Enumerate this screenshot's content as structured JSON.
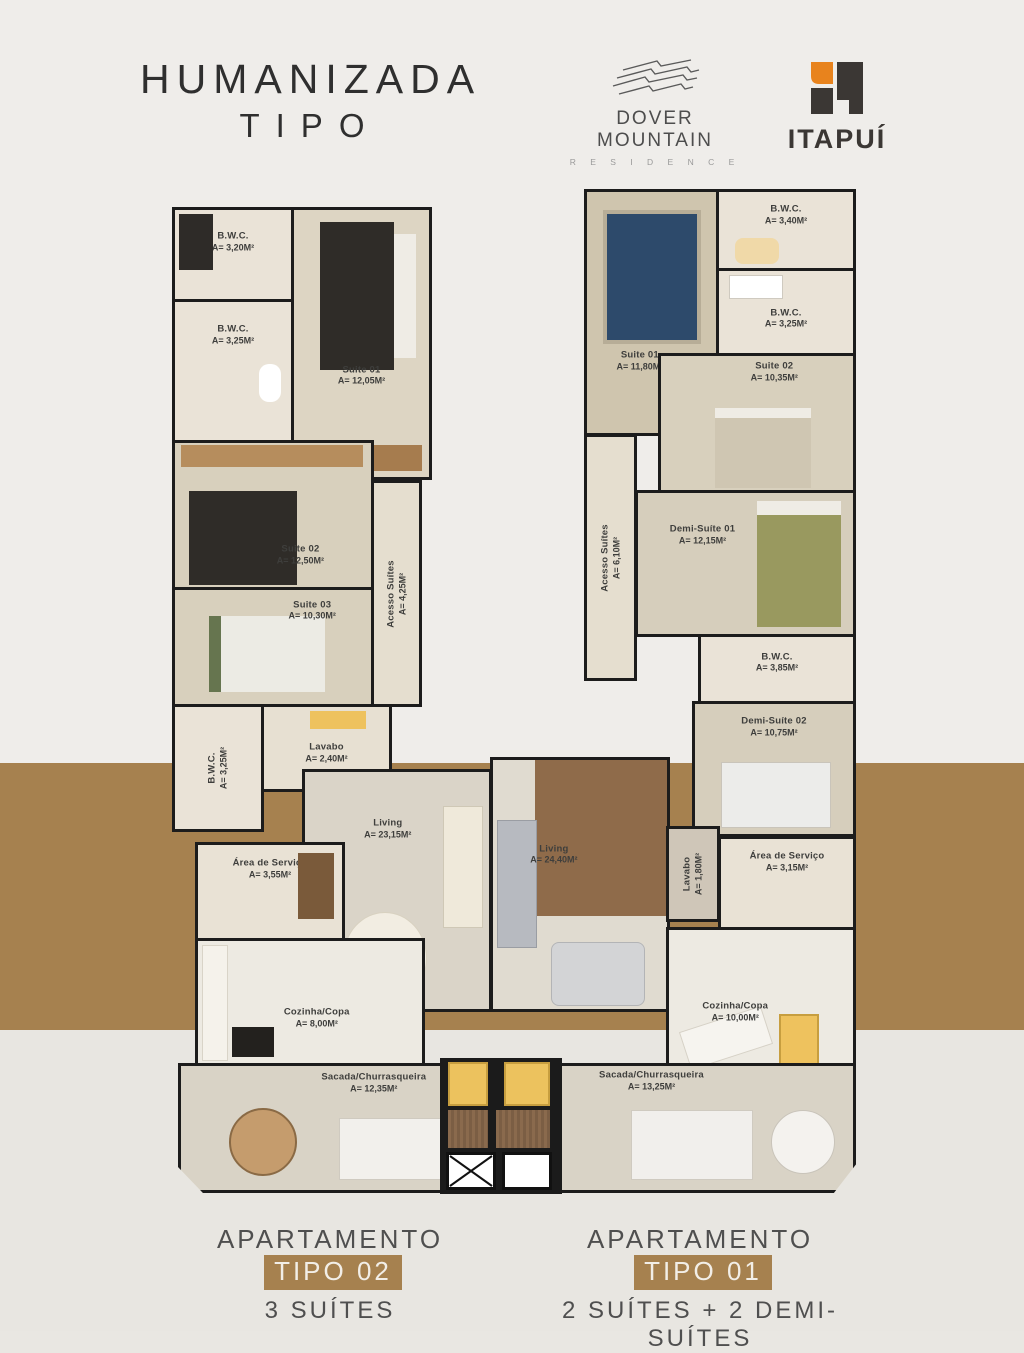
{
  "page": {
    "title_line1": "HUMANIZADA",
    "title_line2": "TIPO"
  },
  "theme": {
    "wall_color": "#1c1c1c",
    "band_brown": "#a6814f",
    "badge_brown": "#a6814f",
    "itapui_orange": "#e8831d",
    "itapui_dark": "#3b3734"
  },
  "logos": {
    "dover": {
      "name": "DOVER MOUNTAIN",
      "subtitle": "R E S I D E N C E"
    },
    "itapui": {
      "name": "ITAPUÍ"
    }
  },
  "apartments": [
    {
      "id": "tipo02",
      "caption": {
        "prefix": "APARTAMENTO",
        "badge": "TIPO 02",
        "subtitle": "3 SUÍTES"
      },
      "rooms": [
        {
          "name": "B.W.C.",
          "area": "A= 3,20M²"
        },
        {
          "name": "Suite 01",
          "area": "A= 12,05M²"
        },
        {
          "name": "B.W.C.",
          "area": "A= 3,25M²"
        },
        {
          "name": "Suite 02",
          "area": "A= 12,50M²"
        },
        {
          "name": "Suite 03",
          "area": "A= 10,30M²"
        },
        {
          "name": "Acesso Suítes",
          "area": "A= 4,25M²"
        },
        {
          "name": "B.W.C.",
          "area": "A= 3,25M²"
        },
        {
          "name": "Lavabo",
          "area": "A= 2,40M²"
        },
        {
          "name": "Living",
          "area": "A= 23,15M²"
        },
        {
          "name": "Área de Serviço",
          "area": "A= 3,55M²"
        },
        {
          "name": "Cozinha/Copa",
          "area": "A= 8,00M²"
        },
        {
          "name": "Sacada/Churrasqueira",
          "area": "A= 12,35M²"
        }
      ]
    },
    {
      "id": "tipo01",
      "caption": {
        "prefix": "APARTAMENTO",
        "badge": "TIPO 01",
        "subtitle": "2 SUÍTES + 2 DEMI-SUÍTES"
      },
      "rooms": [
        {
          "name": "Suite 01",
          "area": "A= 11,80M²"
        },
        {
          "name": "B.W.C.",
          "area": "A= 3,40M²"
        },
        {
          "name": "B.W.C.",
          "area": "A= 3,25M²"
        },
        {
          "name": "Suite 02",
          "area": "A= 10,35M²"
        },
        {
          "name": "Acesso Suítes",
          "area": "A= 6,10M²"
        },
        {
          "name": "Demi-Suíte 01",
          "area": "A= 12,15M²"
        },
        {
          "name": "B.W.C.",
          "area": "A= 3,85M²"
        },
        {
          "name": "Demi-Suíte 02",
          "area": "A= 10,75M²"
        },
        {
          "name": "Living",
          "area": "A= 24,40M²"
        },
        {
          "name": "Lavabo",
          "area": "A= 1,80M²"
        },
        {
          "name": "Área de Serviço",
          "area": "A= 3,15M²"
        },
        {
          "name": "Cozinha/Copa",
          "area": "A= 10,00M²"
        },
        {
          "name": "Sacada/Churrasqueira",
          "area": "A= 13,25M²"
        }
      ]
    }
  ]
}
